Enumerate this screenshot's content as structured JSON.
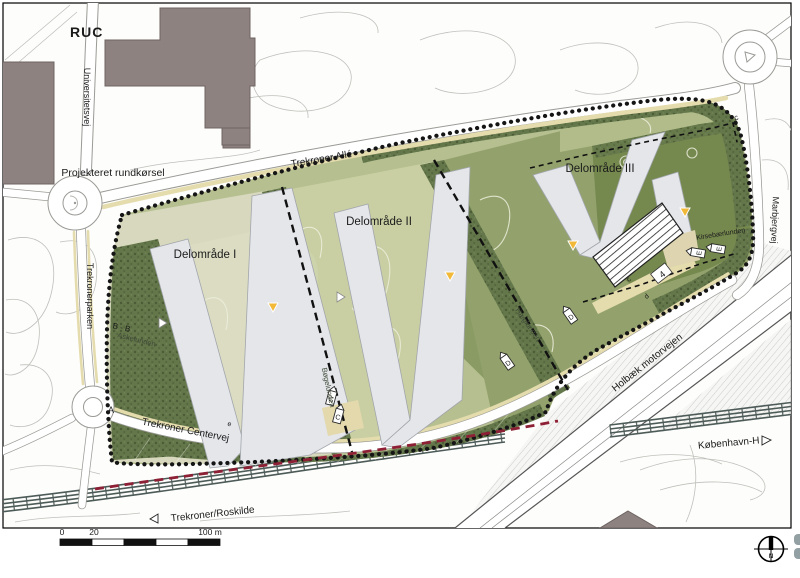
{
  "map": {
    "labels": {
      "ruc": "RUC",
      "universitetsvej": "Universitetsvej",
      "projekteret_rundkorsel": "Projekteret rundkørsel",
      "trekroner_alle": "Trekroner Allé",
      "delomraade_1": "Delområde I",
      "delomraade_2": "Delområde II",
      "delomraade_3": "Delområde III",
      "trekronerparken": "Trekronerparken",
      "askelunden": "Askelunden",
      "bogelunden": "Bøgelunden",
      "haeglunden": "Hæglunden",
      "kirsebaerlunden": "Kirsebærlunden",
      "marbjergvej": "Marbjergvej",
      "trekroner_centervej": "Trekroner Centervej",
      "holbaek_motorvejen": "Holbæk motorvejen",
      "trekroner_roskilde": "Trekroner/Roskilde",
      "kobenhavn_h": "København-H"
    },
    "section_markers": {
      "a": "A",
      "b_b": "B - B",
      "c": "C",
      "d": "D",
      "e": "E"
    },
    "small_markers": {
      "c": "c",
      "d": "d",
      "e": "e",
      "road_4": "4"
    },
    "scale_bar": {
      "tick_0": "0",
      "tick_20": "20",
      "tick_100": "100 m"
    },
    "north_arrow": {
      "n": "N"
    },
    "colors": {
      "site_green": "#b6bf90",
      "area1_light": "#d7d8bd",
      "area2_courtyard": "#c9cfa2",
      "area2_dark": "#8a9b64",
      "area3_green": "#93a26c",
      "area3_dark_square": "#75884e",
      "area3_top_band": "#b2bc8a",
      "tree_belt": "#64774a",
      "building_zone": "#e4e6ea",
      "path_beige": "#e5dcae",
      "boundary_black": "#151515",
      "railway_red": "#8e2036",
      "ruc_building": "#8d8280",
      "marker_yellow": "#f2b838"
    }
  }
}
